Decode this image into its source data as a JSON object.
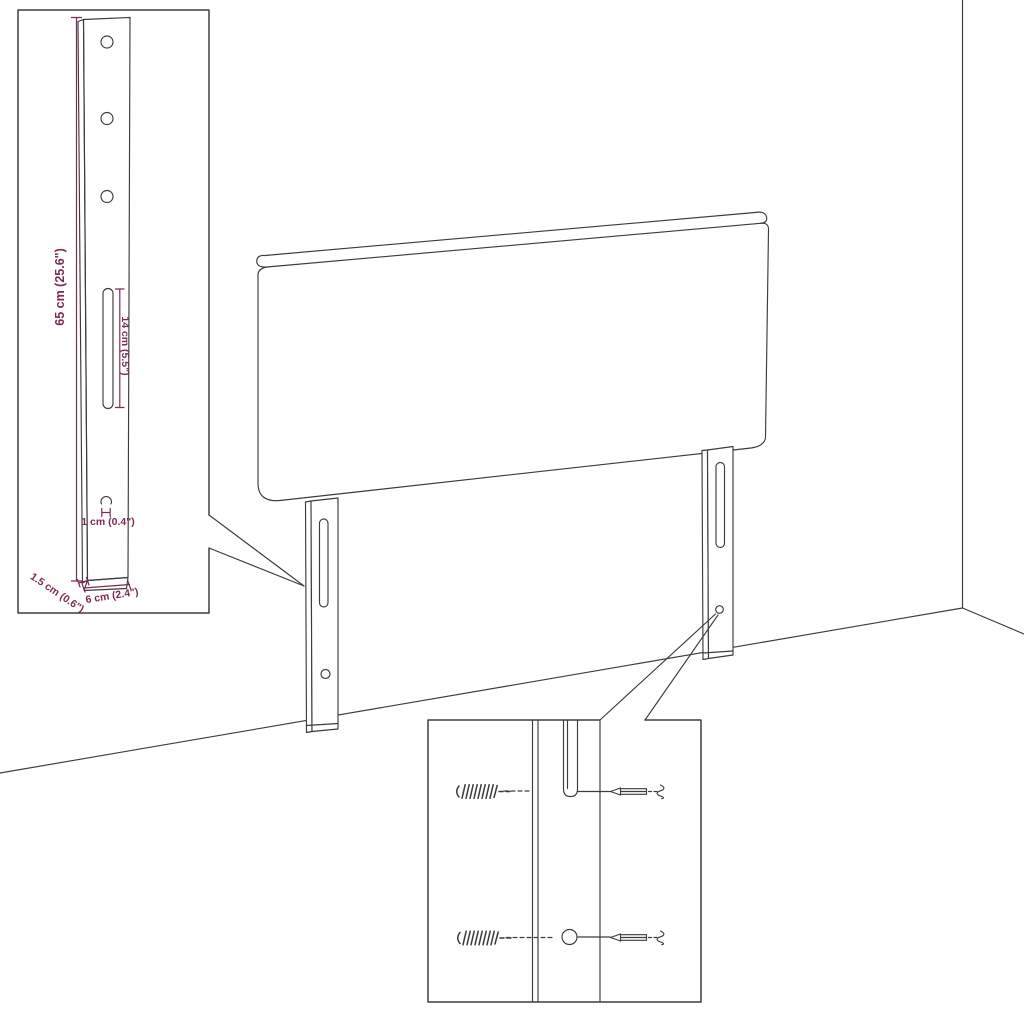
{
  "diagram": {
    "type": "furniture-assembly-line-drawing",
    "colors": {
      "background": "#ffffff",
      "line": "#3c3c3c",
      "dimension": "#7c2b57"
    },
    "bracket_detail": {
      "height_label": "65 cm (25.6\")",
      "slot_length_label": "14 cm (5.5\")",
      "hole_offset_label": "1 cm (0.4\")",
      "side_thickness_label": "1.5 cm (0.6\")",
      "width_label": "6 cm (2.4\")"
    },
    "icons": {
      "bracket_hole": "round screw hole",
      "bracket_slot": "vertical mounting slot",
      "keyhole": "small keyhole opening",
      "leg_slot": "leg mounting slot",
      "leg_hole": "leg screw hole",
      "wood_screw": "large threaded screw",
      "mounting_screw": "small mounting screw with wall plug squiggle"
    }
  }
}
